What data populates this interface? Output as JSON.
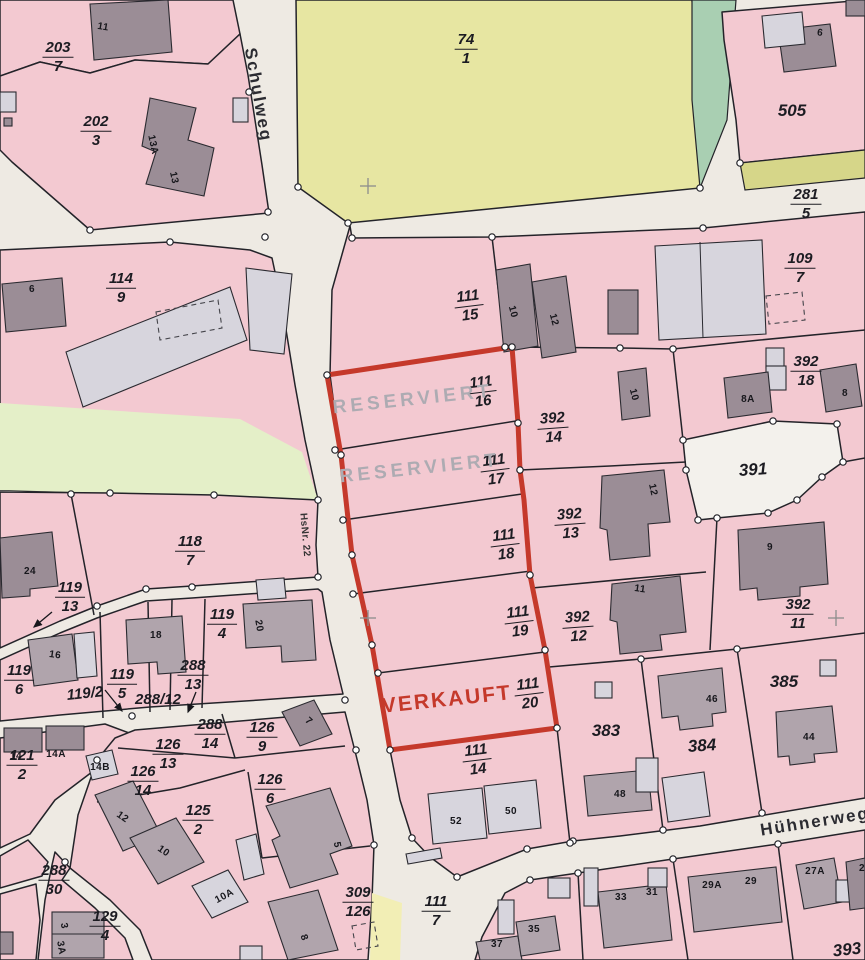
{
  "streets": {
    "schulweg": "Schulweg",
    "huehnerweg": "Hühnerweg",
    "house_ref": "HsNr. 22"
  },
  "status_labels": {
    "reserviert": "RESERVIERT",
    "verkauft": "VERKAUFT"
  },
  "colors": {
    "parcel_pink": "#f3c9d1",
    "field_yellow": "#e7e6a2",
    "vegetation_green": "#a9cfb2",
    "meadow_green": "#e4efc8",
    "strip_olive": "#d6d689",
    "road_white": "#eeeae3",
    "white_parcel": "#f3f1ec",
    "building_light": "#d7d5dd",
    "building_mid": "#b0a4ac",
    "building_dark": "#9b8d96",
    "outline_red": "#c5392b",
    "reserved_gray": "#adabb2"
  },
  "parcels": {
    "p203_7": {
      "num": "203",
      "den": "7"
    },
    "p202_3": {
      "num": "202",
      "den": "3"
    },
    "p74_1": {
      "num": "74",
      "den": "1"
    },
    "p281_5": {
      "num": "281",
      "den": "5"
    },
    "p109_7": {
      "num": "109",
      "den": "7"
    },
    "p114_9": {
      "num": "114",
      "den": "9"
    },
    "p111_15": {
      "num": "111",
      "den": "15"
    },
    "p111_16": {
      "num": "111",
      "den": "16"
    },
    "p392_14": {
      "num": "392",
      "den": "14"
    },
    "p111_17": {
      "num": "111",
      "den": "17"
    },
    "p392_18": {
      "num": "392",
      "den": "18"
    },
    "p392_13": {
      "num": "392",
      "den": "13"
    },
    "p111_18": {
      "num": "111",
      "den": "18"
    },
    "p118_7": {
      "num": "118",
      "den": "7"
    },
    "p119_13": {
      "num": "119",
      "den": "13"
    },
    "p119_4": {
      "num": "119",
      "den": "4"
    },
    "p111_19": {
      "num": "111",
      "den": "19"
    },
    "p392_12": {
      "num": "392",
      "den": "12"
    },
    "p392_11": {
      "num": "392",
      "den": "11"
    },
    "p119_6": {
      "num": "119",
      "den": "6"
    },
    "p288_13": {
      "num": "288",
      "den": "13"
    },
    "p119_5": {
      "num": "119",
      "den": "5"
    },
    "p111_20": {
      "num": "111",
      "den": "20"
    },
    "p121_2": {
      "num": "121",
      "den": "2"
    },
    "p288_14": {
      "num": "288",
      "den": "14"
    },
    "p126_9": {
      "num": "126",
      "den": "9"
    },
    "p126_13": {
      "num": "126",
      "den": "13"
    },
    "p126_14": {
      "num": "126",
      "den": "14"
    },
    "p125_2": {
      "num": "125",
      "den": "2"
    },
    "p126_6": {
      "num": "126",
      "den": "6"
    },
    "p111_14": {
      "num": "111",
      "den": "14"
    },
    "p288_30": {
      "num": "288",
      "den": "30"
    },
    "p309_126": {
      "num": "309",
      "den": "126"
    },
    "p111_7": {
      "num": "111",
      "den": "7"
    },
    "p129_4": {
      "num": "129",
      "den": "4"
    },
    "p119_2": {
      "label": "119/2"
    },
    "p288_12": {
      "label": "288/12"
    },
    "p505": {
      "label": "505"
    },
    "p391": {
      "label": "391"
    },
    "p383": {
      "label": "383"
    },
    "p384": {
      "label": "384"
    },
    "p385": {
      "label": "385"
    },
    "p393": {
      "label": "393"
    }
  },
  "houses": {
    "h11": "11",
    "h13a": "13A",
    "h13": "13",
    "h6_505": "6",
    "h6_114": "6",
    "h10_111": "10",
    "h12_111": "12",
    "h10_392": "10",
    "h8a": "8A",
    "h8_392": "8",
    "h12_392": "12",
    "h9": "9",
    "h11_392": "11",
    "h24": "24",
    "h16": "16",
    "h18": "18",
    "h20": "20",
    "h7": "7",
    "h5": "5",
    "h8_309": "8",
    "h14": "14",
    "h14a": "14A",
    "h14b": "14B",
    "h12_126": "12",
    "h10_125": "10",
    "h10a": "10A",
    "h3": "3",
    "h3a": "3A",
    "h48": "48",
    "h46": "46",
    "h44": "44",
    "h52": "52",
    "h50": "50",
    "h37": "37",
    "h35": "35",
    "h33": "33",
    "h31": "31",
    "h29a": "29A",
    "h29": "29",
    "h27a": "27A",
    "h2": "2"
  }
}
